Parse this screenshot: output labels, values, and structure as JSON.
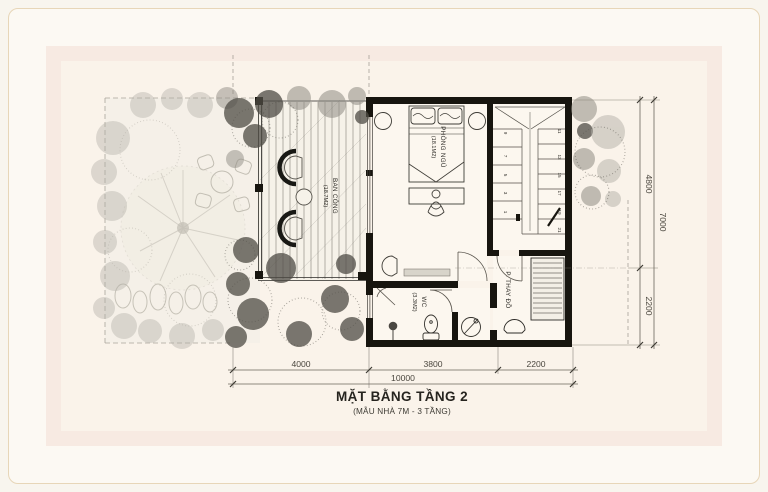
{
  "title": {
    "main": "MẶT BẰNG TẦNG 2",
    "sub": "(MẪU NHÀ 7M - 3 TẦNG)"
  },
  "rooms": {
    "balcony": {
      "name": "BAN CÔNG",
      "area": "(18.7M2)"
    },
    "bedroom": {
      "name": "PHÒNG NGỦ",
      "area": "(18.1M2)"
    },
    "wc": {
      "name": "WC",
      "area": "(3.3M2)"
    },
    "dressing": {
      "name": "P. THAY ĐỒ"
    }
  },
  "stairs": {
    "numbers": [
      "1",
      "3",
      "5",
      "7",
      "9",
      "11",
      "13",
      "15",
      "17",
      "19",
      "21"
    ]
  },
  "dimensions": {
    "bottom": {
      "segments": [
        "4000",
        "3800",
        "2200"
      ],
      "total": "10000"
    },
    "right": {
      "segments": [
        "4800",
        "2200"
      ],
      "total": "7000"
    }
  },
  "colors": {
    "wall": "#17150f",
    "mat_band": "#f7eae2",
    "inner_panel": "#faf3ea",
    "frame_line": "#e7d6b8"
  }
}
